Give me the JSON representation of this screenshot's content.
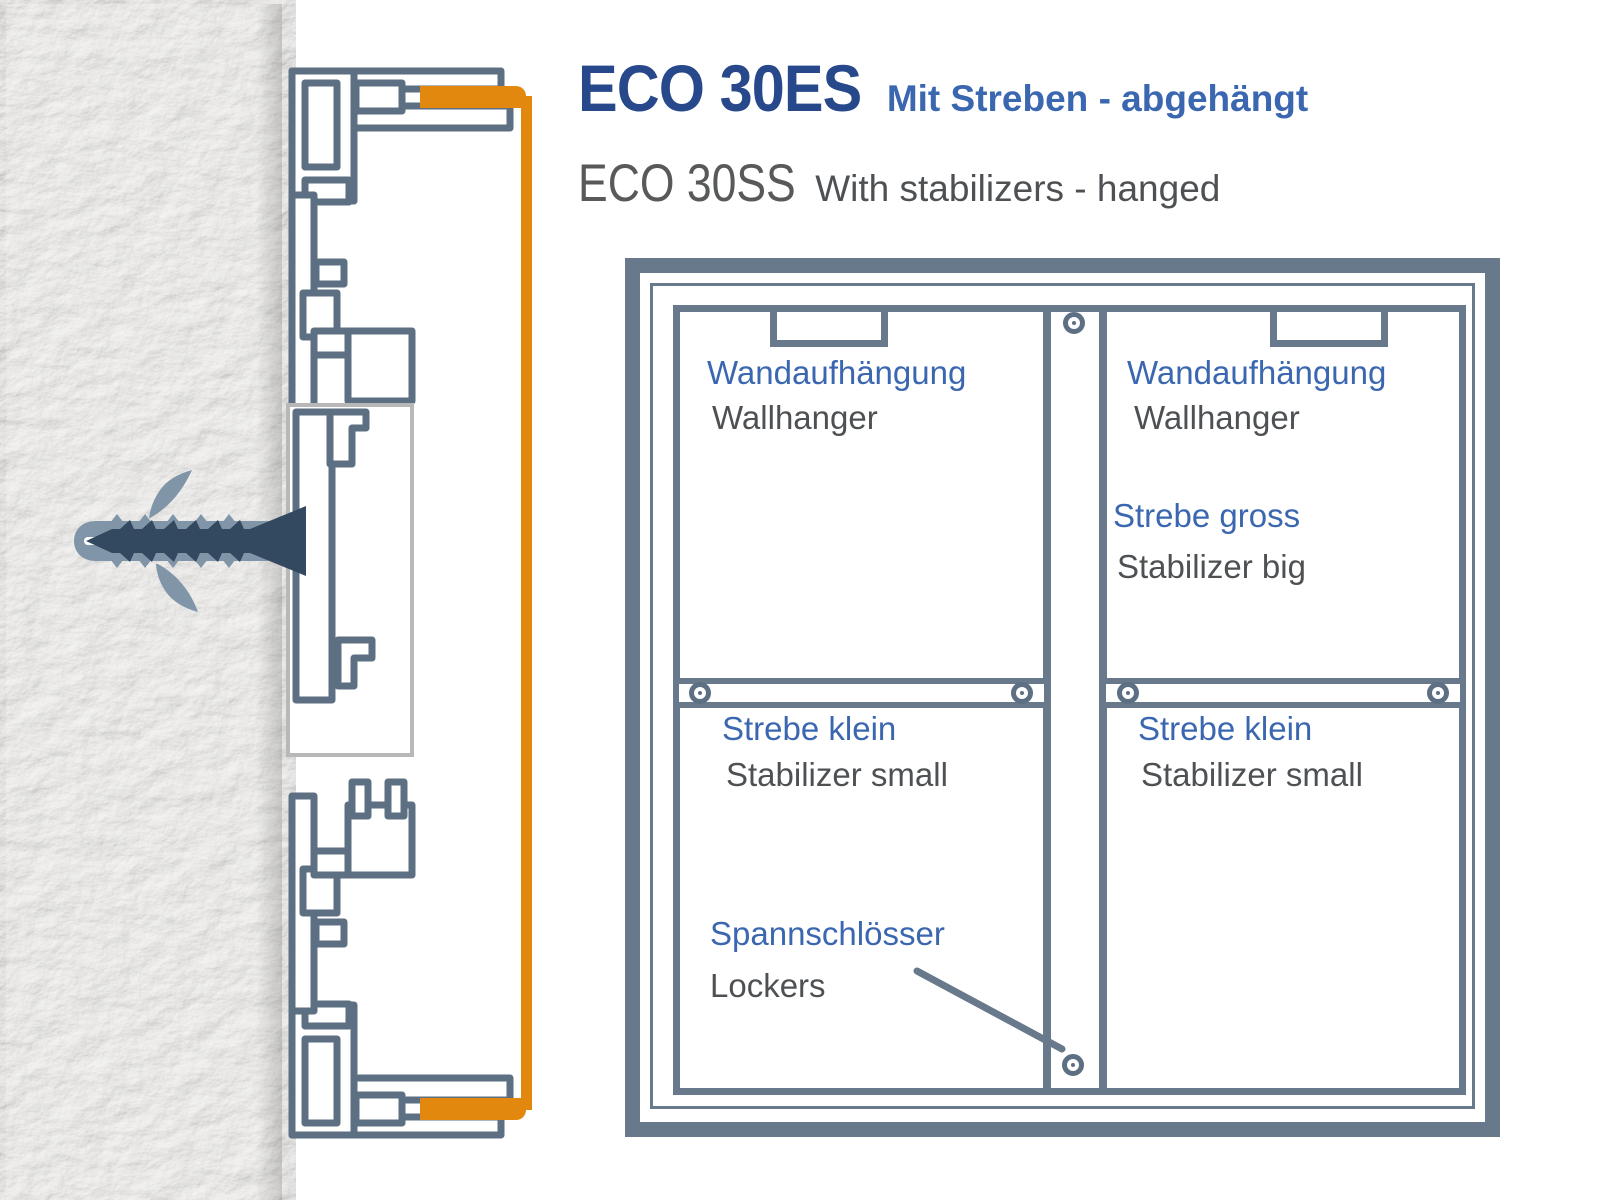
{
  "header": {
    "title_de": "ECO 30ES",
    "subtitle_de": "Mit Streben - abgehängt",
    "title_en": "ECO 30SS",
    "subtitle_en": "With stabilizers - hanged"
  },
  "diagram": {
    "labels": {
      "wallhanger_left": {
        "de": "Wandaufhängung",
        "en": "Wallhanger"
      },
      "wallhanger_right": {
        "de": "Wandaufhängung",
        "en": "Wallhanger"
      },
      "stabilizer_big": {
        "de": "Strebe gross",
        "en": "Stabilizer big"
      },
      "stabilizer_small_left": {
        "de": "Strebe klein",
        "en": "Stabilizer small"
      },
      "stabilizer_small_right": {
        "de": "Strebe klein",
        "en": "Stabilizer small"
      },
      "lockers": {
        "de": "Spannschlösser",
        "en": "Lockers"
      }
    },
    "icons": {
      "screw": "donut-circle-screw-head",
      "wall_anchor": "expansion-dowel-with-screw"
    }
  },
  "colors": {
    "slate": "#68798b",
    "profile": "#5d6f82",
    "orange": "#E2880F",
    "navy": "#27488A",
    "blue": "#3A67B0",
    "gray-text": "#4E5154",
    "gray-title": "#58595B",
    "plate": "#B8B8B8",
    "screw-dark": "#33495F",
    "dowel": "#8096A8"
  }
}
